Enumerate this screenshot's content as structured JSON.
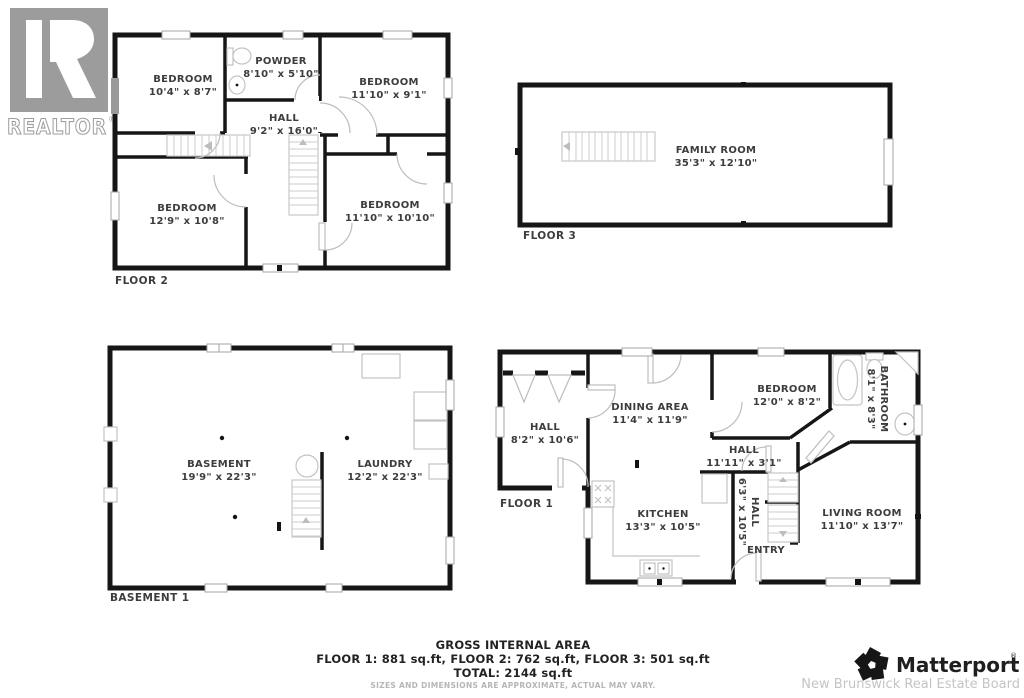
{
  "branding": {
    "realtor": "REALTOR",
    "registered": "®",
    "matterport": "Matterport",
    "board": "New Brunswick Real Estate Board"
  },
  "floors": {
    "floor2": {
      "label": "FLOOR 2",
      "rooms": {
        "bedroom_tl": {
          "name": "BEDROOM",
          "dims": "10'4\" x 8'7\""
        },
        "powder": {
          "name": "POWDER",
          "dims": "8'10\" x 5'10\""
        },
        "bedroom_tr": {
          "name": "BEDROOM",
          "dims": "11'10\" x 9'1\""
        },
        "hall": {
          "name": "HALL",
          "dims": "9'2\" x 16'0\""
        },
        "bedroom_bl": {
          "name": "BEDROOM",
          "dims": "12'9\" x 10'8\""
        },
        "bedroom_br": {
          "name": "BEDROOM",
          "dims": "11'10\" x 10'10\""
        }
      }
    },
    "floor3": {
      "label": "FLOOR 3",
      "rooms": {
        "family_room": {
          "name": "FAMILY ROOM",
          "dims": "35'3\" x 12'10\""
        }
      }
    },
    "basement": {
      "label": "BASEMENT 1",
      "rooms": {
        "basement": {
          "name": "BASEMENT",
          "dims": "19'9\" x 22'3\""
        },
        "laundry": {
          "name": "LAUNDRY",
          "dims": "12'2\" x 22'3\""
        }
      }
    },
    "floor1": {
      "label": "FLOOR 1",
      "rooms": {
        "hall_left": {
          "name": "HALL",
          "dims": "8'2\" x 10'6\""
        },
        "dining": {
          "name": "DINING AREA",
          "dims": "11'4\" x 11'9\""
        },
        "bedroom": {
          "name": "BEDROOM",
          "dims": "12'0\" x 8'2\""
        },
        "bathroom": {
          "name": "BATHROOM",
          "dims": "8'1\" x 8'3\""
        },
        "hall_mid": {
          "name": "HALL",
          "dims": "11'11\" x 3'1\""
        },
        "hall_vert": {
          "name": "HALL",
          "dims": "6'3\" x 10'5\""
        },
        "kitchen": {
          "name": "KITCHEN",
          "dims": "13'3\" x 10'5\""
        },
        "entry": {
          "name": "ENTRY"
        },
        "living": {
          "name": "LIVING ROOM",
          "dims": "11'10\" x 13'7\""
        }
      }
    }
  },
  "summary": {
    "title": "GROSS INTERNAL AREA",
    "line1": "FLOOR 1: 881 sq.ft, FLOOR 2: 762 sq.ft, FLOOR 3: 501 sq.ft",
    "line2": "TOTAL: 2144 sq.ft",
    "disclaimer": "SIZES AND DIMENSIONS ARE APPROXIMATE, ACTUAL MAY VARY."
  },
  "colors": {
    "wall": "#161616",
    "fixture": "#c3c3c3",
    "label_text": "#3d3d3d",
    "muted_text": "#b6b6b6",
    "logo_gray": "#9c9c9c"
  }
}
